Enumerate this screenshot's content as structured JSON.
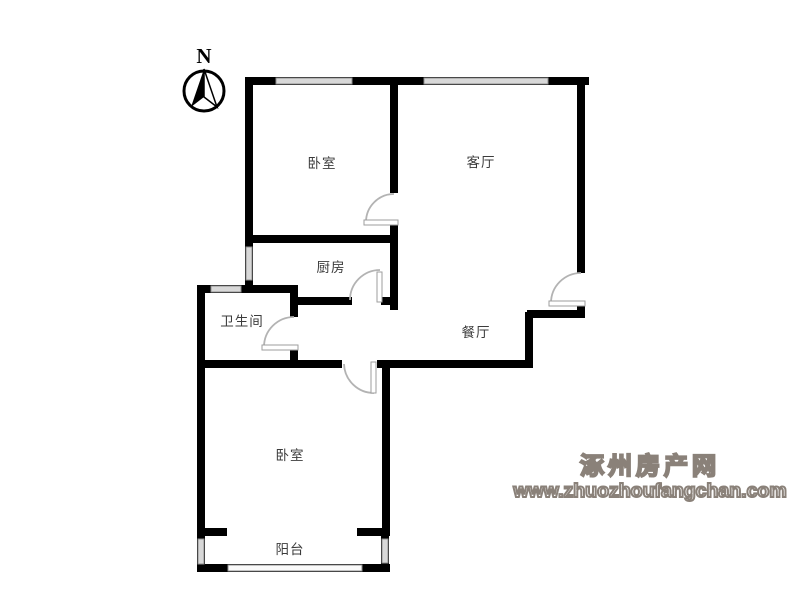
{
  "compass": {
    "north_label": "N"
  },
  "rooms": [
    {
      "id": "bedroom-top",
      "label": "卧室"
    },
    {
      "id": "living-room",
      "label": "客厅"
    },
    {
      "id": "kitchen",
      "label": "厨房"
    },
    {
      "id": "bathroom",
      "label": "卫生间"
    },
    {
      "id": "dining-room",
      "label": "餐厅"
    },
    {
      "id": "bedroom-bottom",
      "label": "卧室"
    },
    {
      "id": "balcony",
      "label": "阳台"
    }
  ],
  "watermark": {
    "site_name": "涿州房产网",
    "site_url": "www.zhuozhoufangchan.com"
  },
  "colors": {
    "wall": "#000000",
    "window_fill": "#d8d8d8",
    "window_border": "#8f8f8f",
    "door_arc": "#b3b3b3",
    "label_text": "#3c3c3c",
    "watermark_outline": "#8a8179",
    "background": "#ffffff"
  }
}
